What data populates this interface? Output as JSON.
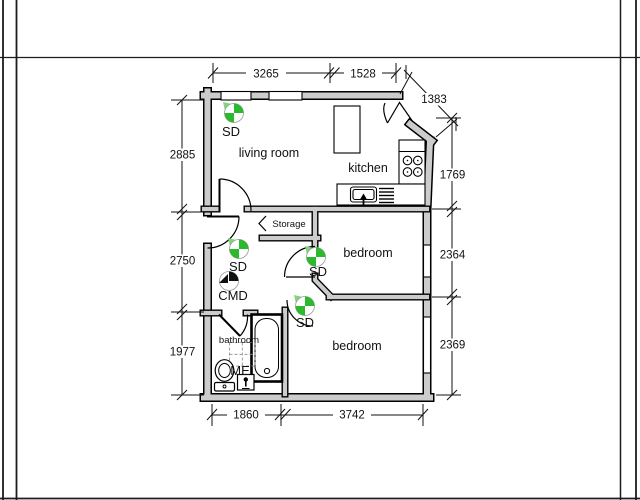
{
  "plan": {
    "rooms": {
      "living_room": "living room",
      "kitchen": "kitchen",
      "bedroom_1": "bedroom",
      "bedroom_2": "bedroom",
      "storage": "Storage",
      "bathroom": "bathroom"
    },
    "devices": {
      "sd_1": "SD",
      "sd_2": "SD",
      "sd_3": "SD",
      "sd_4": "SD",
      "cmd": "CMD",
      "me": "ME"
    },
    "dimensions": {
      "top_living": "3265",
      "top_kitchen": "1528",
      "entrance_diagonal": "1383",
      "left_living": "2885",
      "left_hall": "2750",
      "left_bathroom": "1977",
      "right_kitchen": "1769",
      "right_bedroom_1": "2364",
      "right_bedroom_2": "2369",
      "bottom_bathroom": "1860",
      "bottom_bedroom": "3742"
    },
    "colors": {
      "wall_fill": "#cccccc",
      "sd_green": "#2db92d",
      "sd_green_light": "#7fd67f",
      "cmd_black": "#111111",
      "dim_color": "#111111"
    }
  }
}
